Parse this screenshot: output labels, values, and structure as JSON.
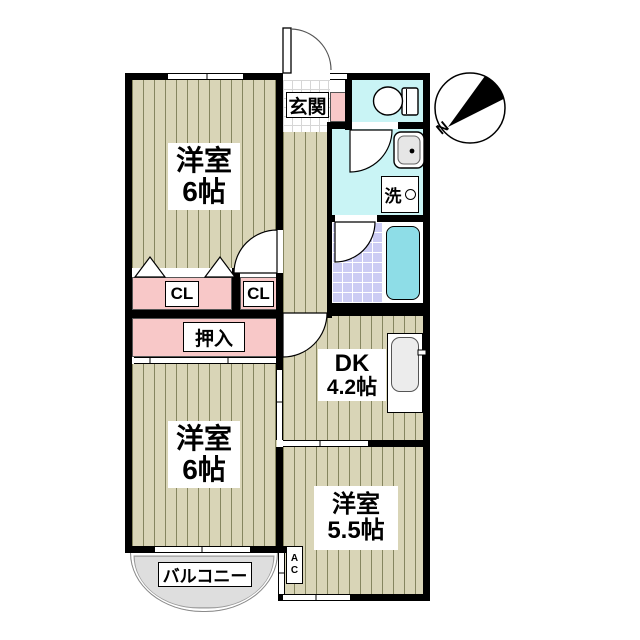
{
  "compass": {
    "north_label": "N"
  },
  "rooms": {
    "western_room_top": {
      "name": "洋室",
      "size": "6帖"
    },
    "western_room_bottom": {
      "name": "洋室",
      "size": "6帖"
    },
    "western_room_right": {
      "name": "洋室",
      "size": "5.5帖"
    },
    "dining_kitchen": {
      "name": "DK",
      "size": "4.2帖"
    },
    "entrance": {
      "label": "玄関"
    },
    "closet_left": {
      "label": "CL"
    },
    "closet_right": {
      "label": "CL"
    },
    "oshiire": {
      "label": "押入"
    },
    "laundry": {
      "label": "洗"
    },
    "balcony": {
      "label": "バルコニー"
    },
    "air_conditioner": {
      "line1": "A",
      "line2": "C"
    }
  },
  "colors": {
    "floor_stripe_base": "#d9d5b7",
    "floor_stripe_line": "#85855f",
    "closet_pink": "#f8c8c8",
    "wet_area_cyan": "#c9f4f5",
    "bath_tile_lavender": "#ccccf4",
    "bathtub_cyan": "#8edde7",
    "balcony_gray": "#dedede",
    "wall_black": "#000000"
  }
}
